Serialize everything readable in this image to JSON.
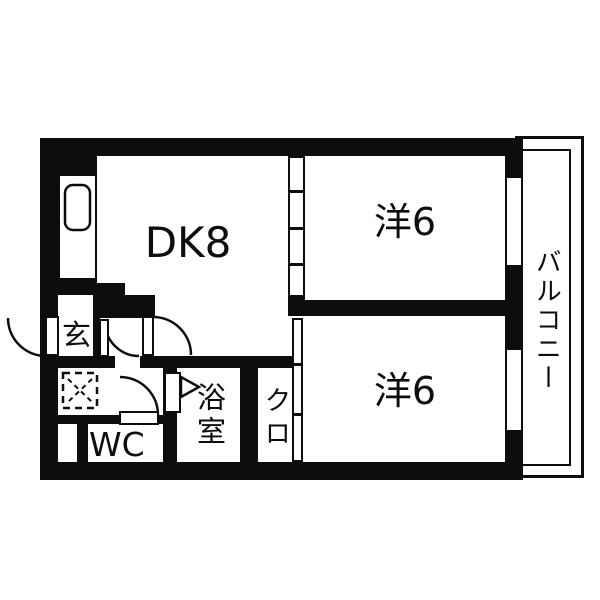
{
  "title": "2DK apartment floor plan",
  "rooms": {
    "dining_kitchen": {
      "label": "DK8"
    },
    "western_room_top": {
      "label": "洋6"
    },
    "western_room_bottom": {
      "label": "洋6"
    },
    "balcony": {
      "label": "バルコニー"
    },
    "entrance": {
      "label": "玄"
    },
    "toilet": {
      "label": "WC"
    },
    "bathroom": {
      "label": "浴室"
    },
    "closet": {
      "label": "クロ"
    }
  },
  "fixtures": {
    "kitchen_sink": "sink-icon",
    "washing_machine_space": "dashed-square-cross-icon",
    "doors": "quarter-arc-swing-icons",
    "sliding_partitions": "segmented-strip-icons"
  },
  "colors": {
    "ink": "#0f0d0b",
    "background": "#ffffff"
  }
}
